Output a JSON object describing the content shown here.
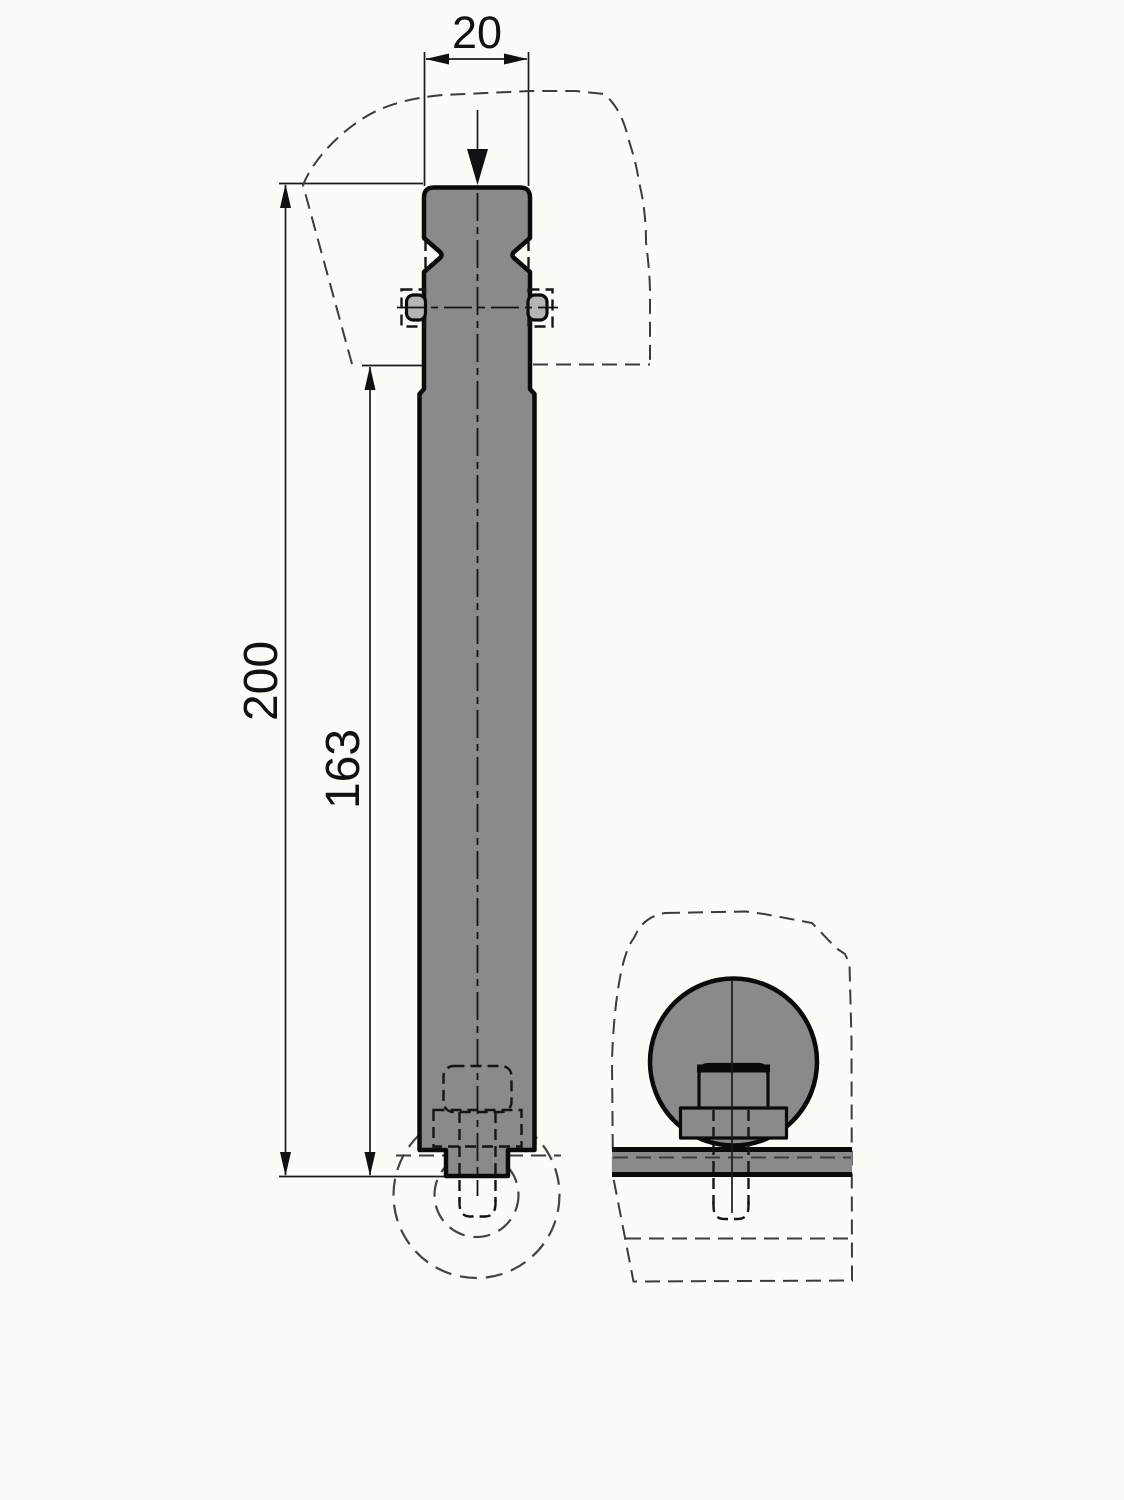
{
  "drawing": {
    "type": "technical-drawing",
    "dimensions": {
      "width_top": "20",
      "overall_length": "200",
      "shaft_length": "163"
    },
    "colors": {
      "background": "#fbfbf8",
      "part_fill": "#8a8a8a",
      "pin_fill": "#b4b4b4",
      "outline": "#0a0a0a",
      "dim": "#141414"
    }
  }
}
